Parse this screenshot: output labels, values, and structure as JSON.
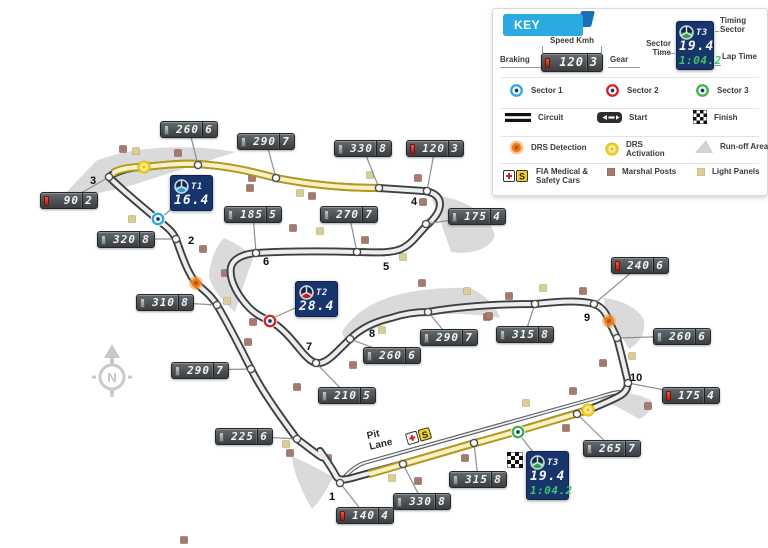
{
  "key": {
    "header": "KEY",
    "speed_demo": {
      "speed": "120",
      "gear": "3"
    },
    "timing_demo": {
      "sector": "T3",
      "sector_time": "19.4",
      "lap_time": "1:04.2"
    },
    "labels": {
      "braking": "Braking",
      "speed_kmh": "Speed Kmh",
      "gear": "Gear",
      "sector_time": "Sector Time",
      "timing_sector": "Timing Sector",
      "lap_time": "Lap Time"
    },
    "items": {
      "sector1": "Sector 1",
      "sector2": "Sector 2",
      "sector3": "Sector 3",
      "circuit": "Circuit",
      "start": "Start",
      "finish": "Finish",
      "drs_detection": "DRS Detection",
      "drs_activation": "DRS Activation",
      "runoff": "Run-off Areas",
      "fia": "FIA Medical & Safety Cars",
      "marshal": "Marshal Posts",
      "light": "Light Panels"
    }
  },
  "map": {
    "pit_lane_label": "Pit Lane",
    "safety_car_letter": "S",
    "speed_markers": [
      {
        "speed": "260",
        "gear": "6",
        "braking": false,
        "x": 160,
        "y": 121,
        "tx": 198,
        "ty": 165
      },
      {
        "speed": "290",
        "gear": "7",
        "braking": false,
        "x": 237,
        "y": 133,
        "tx": 276,
        "ty": 178
      },
      {
        "speed": "330",
        "gear": "8",
        "braking": false,
        "x": 334,
        "y": 140,
        "tx": 379,
        "ty": 188
      },
      {
        "speed": "120",
        "gear": "3",
        "braking": true,
        "x": 406,
        "y": 140,
        "tx": 427,
        "ty": 191
      },
      {
        "speed": "90",
        "gear": "2",
        "braking": true,
        "x": 40,
        "y": 192,
        "tx": 109,
        "ty": 177
      },
      {
        "speed": "320",
        "gear": "8",
        "braking": false,
        "x": 97,
        "y": 231,
        "tx": 176,
        "ty": 239
      },
      {
        "speed": "185",
        "gear": "5",
        "braking": false,
        "x": 224,
        "y": 206,
        "tx": 256,
        "ty": 253
      },
      {
        "speed": "270",
        "gear": "7",
        "braking": false,
        "x": 320,
        "y": 206,
        "tx": 357,
        "ty": 252
      },
      {
        "speed": "175",
        "gear": "4",
        "braking": false,
        "x": 448,
        "y": 208,
        "tx": 426,
        "ty": 224
      },
      {
        "speed": "310",
        "gear": "8",
        "braking": false,
        "x": 136,
        "y": 294,
        "tx": 217,
        "ty": 305
      },
      {
        "speed": "290",
        "gear": "7",
        "braking": false,
        "x": 171,
        "y": 362,
        "tx": 251,
        "ty": 369
      },
      {
        "speed": "225",
        "gear": "6",
        "braking": false,
        "x": 215,
        "y": 428,
        "tx": 297,
        "ty": 439
      },
      {
        "speed": "210",
        "gear": "5",
        "braking": false,
        "x": 318,
        "y": 387,
        "tx": 316,
        "ty": 363
      },
      {
        "speed": "260",
        "gear": "6",
        "braking": false,
        "x": 363,
        "y": 347,
        "tx": 350,
        "ty": 339
      },
      {
        "speed": "290",
        "gear": "7",
        "braking": false,
        "x": 420,
        "y": 329,
        "tx": 428,
        "ty": 312
      },
      {
        "speed": "315",
        "gear": "8",
        "braking": false,
        "x": 496,
        "y": 326,
        "tx": 535,
        "ty": 304
      },
      {
        "speed": "240",
        "gear": "6",
        "braking": true,
        "x": 611,
        "y": 257,
        "tx": 594,
        "ty": 304
      },
      {
        "speed": "260",
        "gear": "6",
        "braking": false,
        "x": 653,
        "y": 328,
        "tx": 617,
        "ty": 338
      },
      {
        "speed": "175",
        "gear": "4",
        "braking": true,
        "x": 662,
        "y": 387,
        "tx": 628,
        "ty": 383
      },
      {
        "speed": "265",
        "gear": "7",
        "braking": false,
        "x": 583,
        "y": 440,
        "tx": 577,
        "ty": 414
      },
      {
        "speed": "315",
        "gear": "8",
        "braking": false,
        "x": 449,
        "y": 471,
        "tx": 474,
        "ty": 443
      },
      {
        "speed": "330",
        "gear": "8",
        "braking": false,
        "x": 393,
        "y": 493,
        "tx": 403,
        "ty": 464
      },
      {
        "speed": "140",
        "gear": "4",
        "braking": true,
        "x": 336,
        "y": 507,
        "tx": 340,
        "ty": 483
      }
    ],
    "turns": [
      {
        "n": "1",
        "x": 329,
        "y": 491
      },
      {
        "n": "2",
        "x": 188,
        "y": 235
      },
      {
        "n": "3",
        "x": 90,
        "y": 175
      },
      {
        "n": "4",
        "x": 411,
        "y": 196
      },
      {
        "n": "5",
        "x": 383,
        "y": 261
      },
      {
        "n": "6",
        "x": 263,
        "y": 256
      },
      {
        "n": "7",
        "x": 306,
        "y": 341
      },
      {
        "n": "8",
        "x": 369,
        "y": 328
      },
      {
        "n": "9",
        "x": 584,
        "y": 312
      },
      {
        "n": "10",
        "x": 630,
        "y": 372
      }
    ],
    "timing_boxes": [
      {
        "sector": "T1",
        "time": "16.4",
        "lap": "",
        "x": 170,
        "y": 175,
        "ax": 161,
        "ay": 218,
        "color_key": "sector1"
      },
      {
        "sector": "T2",
        "time": "28.4",
        "lap": "",
        "x": 295,
        "y": 281,
        "ax": 273,
        "ay": 318,
        "color_key": "sector2"
      },
      {
        "sector": "T3",
        "time": "19.4",
        "lap": "1:04.2",
        "x": 526,
        "y": 451,
        "ax": 519,
        "ay": 434,
        "color_key": "sector3"
      }
    ],
    "sector_markers": [
      {
        "type": "sector1",
        "x": 158,
        "y": 219
      },
      {
        "type": "sector2",
        "x": 270,
        "y": 321
      },
      {
        "type": "sector3",
        "x": 518,
        "y": 432
      }
    ],
    "drs_markers": [
      {
        "type": "drs_detection",
        "x": 196,
        "y": 283
      },
      {
        "type": "drs_detection",
        "x": 609,
        "y": 321
      },
      {
        "type": "drs_activation",
        "x": 144,
        "y": 167
      },
      {
        "type": "drs_activation",
        "x": 588,
        "y": 410
      }
    ],
    "marshal_posts": [
      [
        123,
        149
      ],
      [
        178,
        153
      ],
      [
        250,
        188
      ],
      [
        203,
        249
      ],
      [
        252,
        178
      ],
      [
        312,
        196
      ],
      [
        418,
        178
      ],
      [
        423,
        202
      ],
      [
        293,
        228
      ],
      [
        365,
        240
      ],
      [
        225,
        273
      ],
      [
        422,
        283
      ],
      [
        487,
        317
      ],
      [
        253,
        322
      ],
      [
        297,
        387
      ],
      [
        353,
        365
      ],
      [
        248,
        342
      ],
      [
        290,
        453
      ],
      [
        328,
        458
      ],
      [
        418,
        481
      ],
      [
        465,
        458
      ],
      [
        566,
        428
      ],
      [
        583,
        291
      ],
      [
        603,
        363
      ],
      [
        573,
        391
      ],
      [
        648,
        406
      ],
      [
        489,
        316
      ],
      [
        509,
        296
      ],
      [
        184,
        540
      ]
    ],
    "light_panels": [
      [
        136,
        151
      ],
      [
        132,
        219
      ],
      [
        300,
        193
      ],
      [
        370,
        175
      ],
      [
        320,
        231
      ],
      [
        403,
        257
      ],
      [
        467,
        291
      ],
      [
        382,
        330
      ],
      [
        227,
        301
      ],
      [
        286,
        444
      ],
      [
        392,
        478
      ],
      [
        526,
        403
      ],
      [
        543,
        288
      ],
      [
        632,
        356
      ]
    ]
  },
  "colors": {
    "sector1": "#29abe2",
    "sector2": "#d42027",
    "sector3": "#3bb54a",
    "navy": "#17346b",
    "lcd_green": "#3fc468",
    "braking_red": "#c8281e",
    "drs_detection": "#ef7d1c",
    "drs_activation": "#f3d02a",
    "marshal": "#a87a6b",
    "light_panel": "#d6cf96",
    "track": "#3c4043",
    "drs_zone": "#b59a1a",
    "runoff": "#dadada",
    "key_accent": "#29abe2"
  }
}
